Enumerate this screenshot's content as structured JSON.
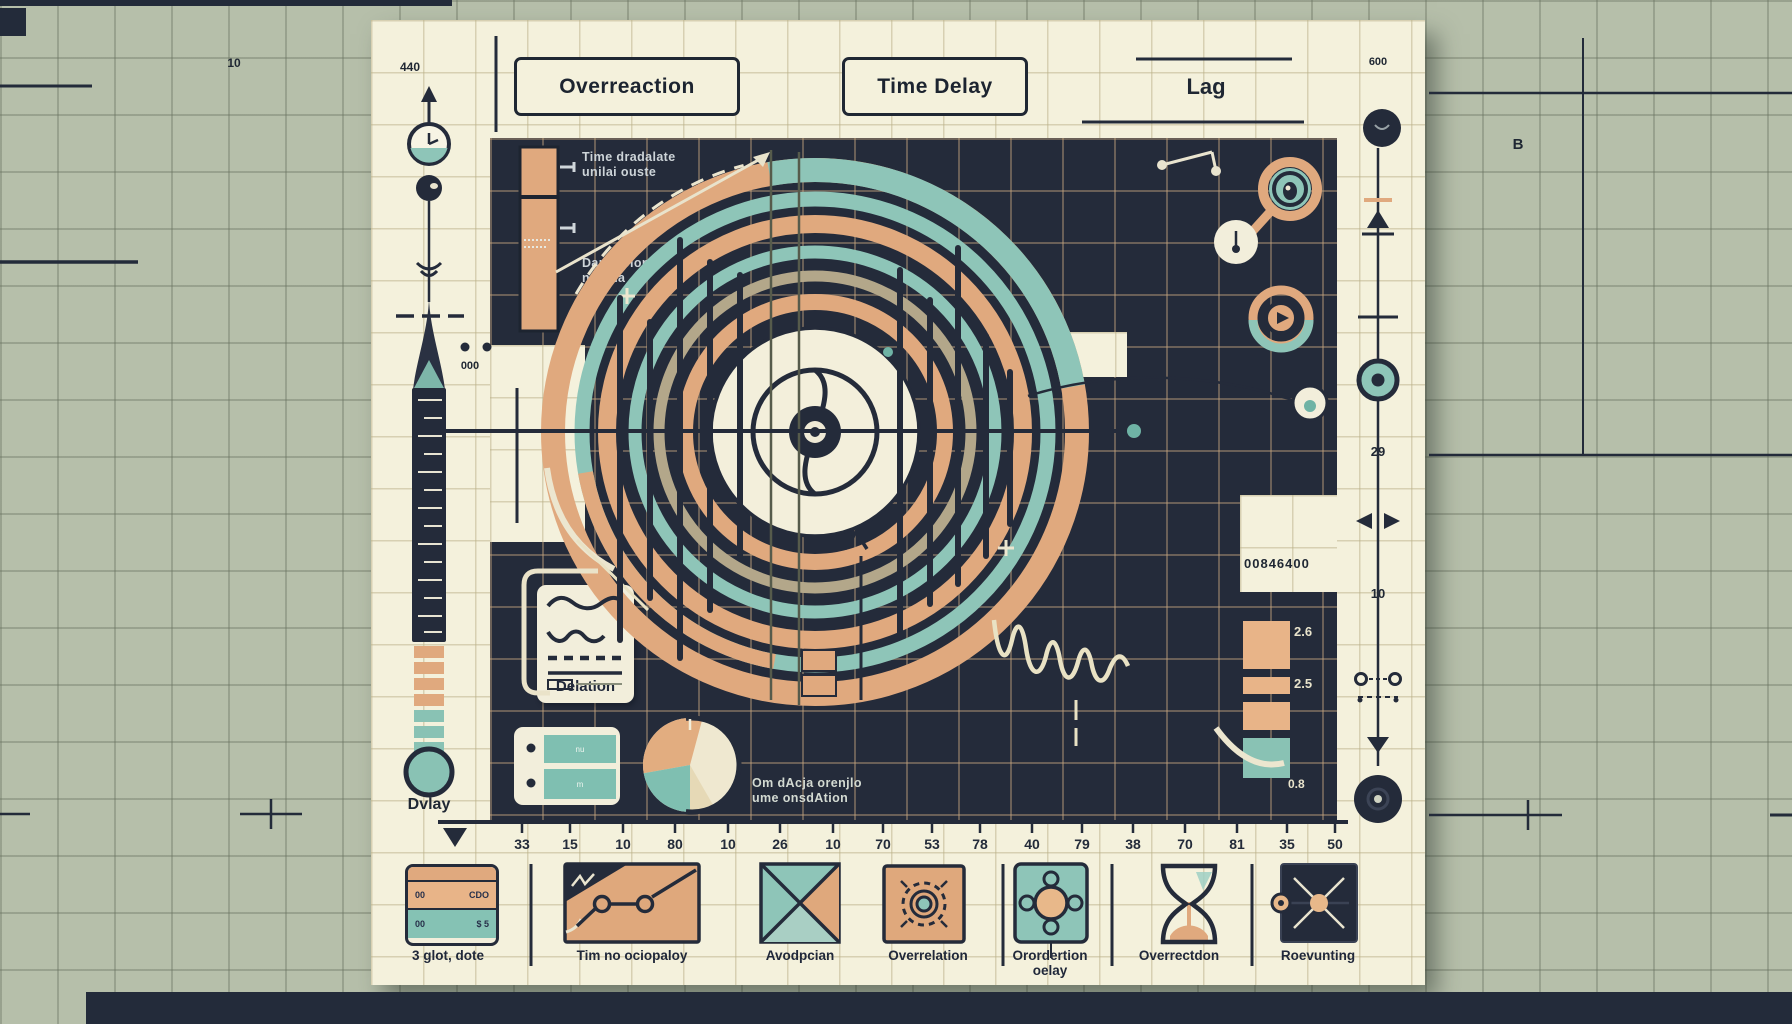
{
  "header": {
    "tick_left": "440",
    "box_overreaction": "Overreaction",
    "box_time_delay": "Time Delay",
    "lag": "Lag",
    "tick_right": "600"
  },
  "background": {
    "top_left_value": "10",
    "side_note": "B"
  },
  "gauge": {
    "delay_label": "Dvlay"
  },
  "panel": {
    "bar_callout_top": [
      "Time dradalate",
      "unilai ouste"
    ],
    "bar_callout_bottom": [
      "Dan alolont",
      "nuiona"
    ],
    "bar_dots_value": "000",
    "delation_card": {
      "label": "Delation"
    },
    "pie_caption": [
      "Om dAcja orenjlo",
      "ume onsdAtion"
    ],
    "mini_cells": [
      "B",
      "O"
    ],
    "readout_value": "00846400",
    "stack_labels": {
      "top": "2.6",
      "mid": "2.5",
      "bottom": "0.8"
    },
    "table_card": {
      "row1": "nu",
      "row2": "m"
    }
  },
  "right_ruler": {
    "value_top": "29",
    "value_bottom": "10"
  },
  "axis": {
    "tick_labels": [
      "33",
      "15",
      "10",
      "80",
      "10",
      "26",
      "10",
      "70",
      "53",
      "78",
      "40",
      "79",
      "38",
      "70",
      "81",
      "35",
      "50"
    ]
  },
  "legend": {
    "items": [
      {
        "label": "3 glot, dote"
      },
      {
        "label": "Tim no ociopaloy"
      },
      {
        "label": "Avodpcian"
      },
      {
        "label": "Overrelation"
      },
      {
        "label": "Orordertion",
        "label2": "oelay"
      },
      {
        "label": "Overrectdon"
      },
      {
        "label": "Roevunting"
      }
    ]
  },
  "legend_table": {
    "r1c1": "00",
    "r1c2": "CDO",
    "r2c1": "00",
    "r2c2": "$ 5"
  },
  "colors": {
    "paper": "#f4f1dc",
    "panel": "#232b3a",
    "orange": "#e0a97e",
    "teal": "#8ec5b8",
    "olive": "#b3a78a",
    "background": "#b7bfab"
  }
}
